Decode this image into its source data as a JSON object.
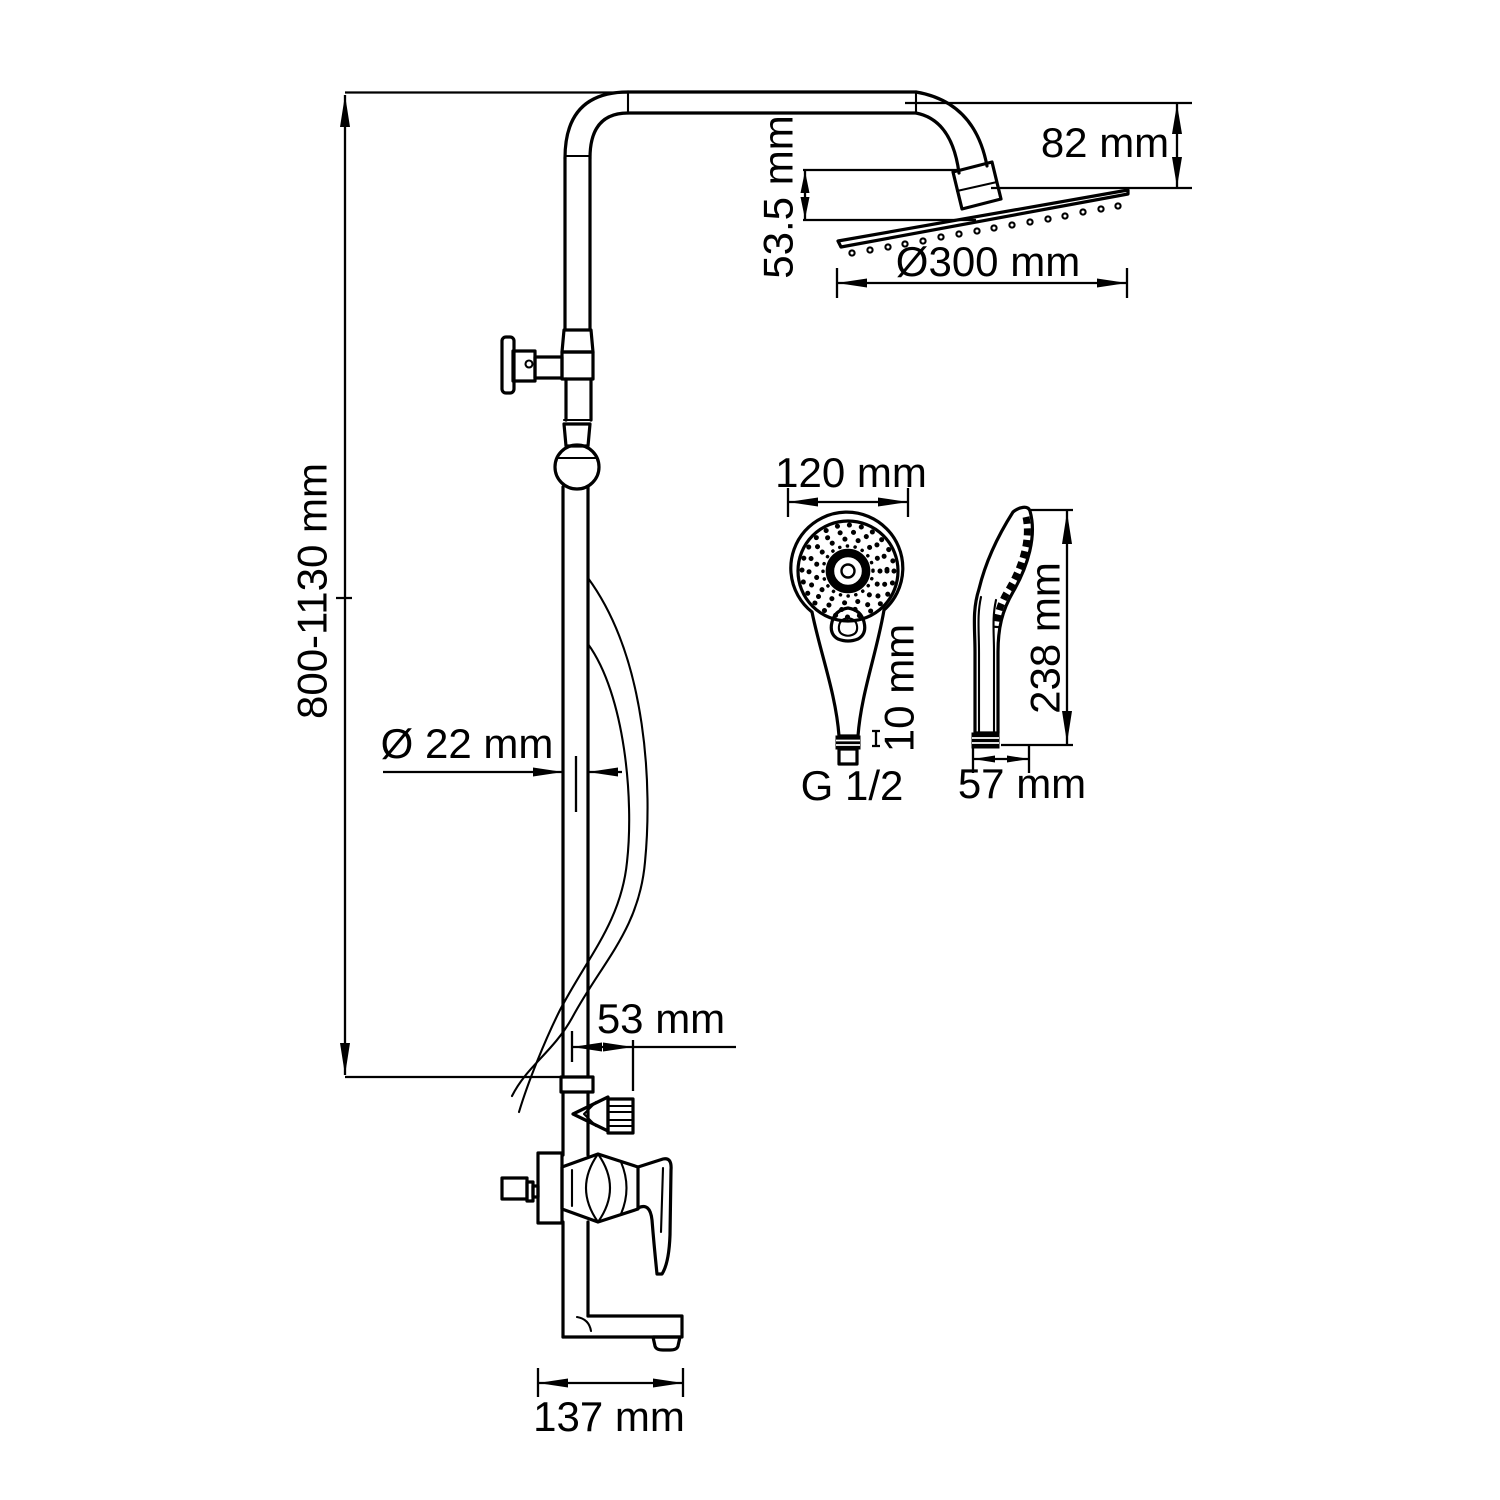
{
  "title": "Shower column dimensional drawing",
  "colors": {
    "background": "#ffffff",
    "line": "#000000"
  },
  "dimensions": {
    "column_height": "800-1130 mm",
    "head_drop": "82 mm",
    "head_offset": "53.5 mm",
    "head_diameter": "Ø300 mm",
    "pipe_diameter": "Ø 22 mm",
    "outlet_offset": "53 mm",
    "spout_reach": "137 mm",
    "hand_shower_width": "120 mm",
    "hand_shower_connector": "10 mm",
    "thread_size": "G 1/2",
    "hand_shower_length": "238 mm",
    "hand_shower_depth": "57 mm"
  }
}
